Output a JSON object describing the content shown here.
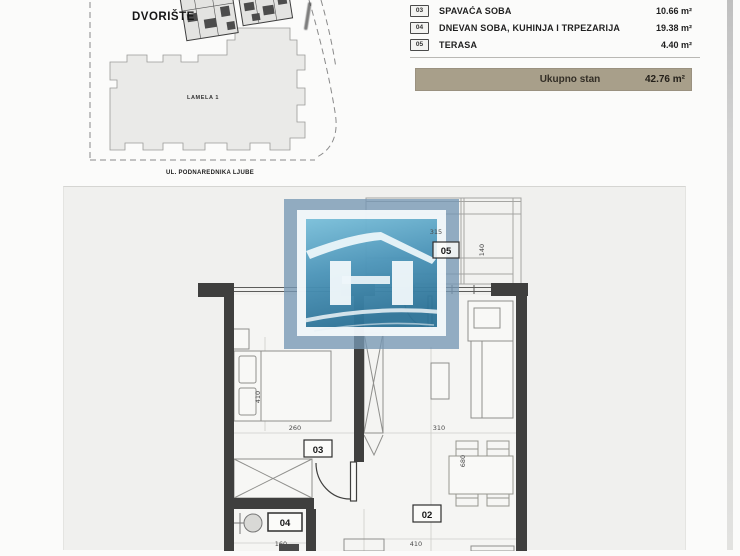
{
  "site_plan": {
    "courtyard_label": "DVORIŠTE",
    "building_label": "LAMELA 1",
    "street_label": "UL. PODNAREDNIKA LJUBE"
  },
  "area_table": {
    "rows": [
      {
        "num": "03",
        "name": "SPAVAĆA SOBA",
        "area": "10.66 m²"
      },
      {
        "num": "04",
        "name": "DNEVAN SOBA, KUHINJA I TRPEZARIJA",
        "area": "19.38 m²"
      },
      {
        "num": "05",
        "name": "TERASA",
        "area": "4.40 m²"
      }
    ],
    "total_label": "Ukupno stan",
    "total_area": "42.76 m²",
    "total_bar_color": "#a89f8a"
  },
  "floor_plan": {
    "rooms": {
      "terrace": "05",
      "bedroom": "03",
      "living": "02",
      "bathroom": "04"
    },
    "dimensions": {
      "terrace_width": "315",
      "terrace_depth": "140",
      "bedroom_depth": "410",
      "bedroom_width": "260",
      "living_width": "310",
      "living_depth": "680",
      "bathroom_width": "160",
      "living_bottom_width": "410"
    },
    "watermark_colors": {
      "outer": "#7697b3",
      "frame": "#f7fbfd",
      "sky_top": "#7cc6e0",
      "sky_bottom": "#256f94"
    }
  }
}
